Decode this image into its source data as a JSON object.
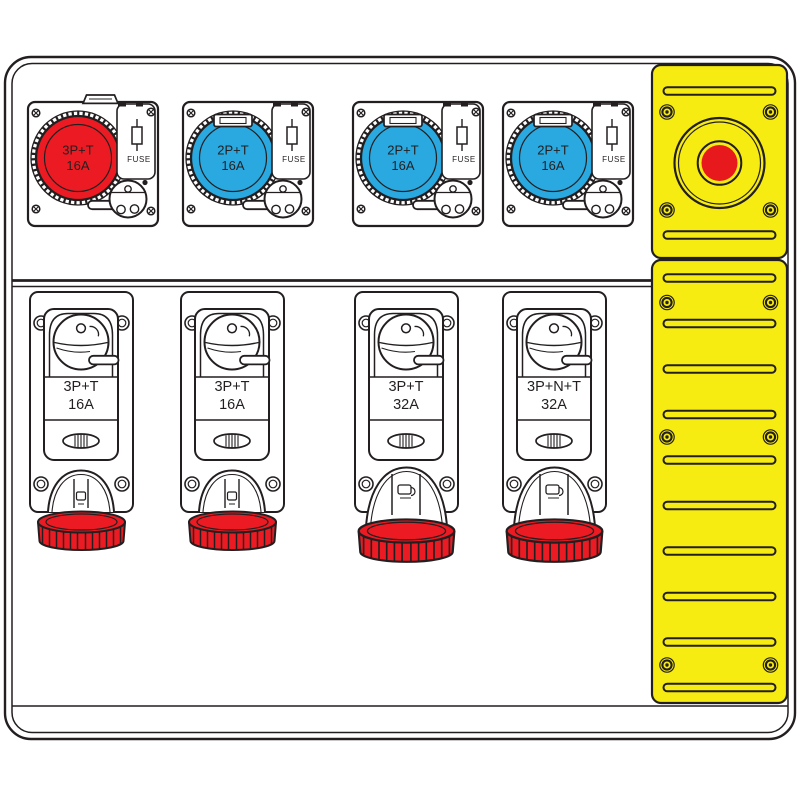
{
  "colors": {
    "line": "#231f20",
    "socket_red": "#ec1b23",
    "socket_blue": "#29a9e0",
    "panel_yellow": "#f7ec11",
    "button_red": "#e8191c",
    "cap_red": "#ec1b23"
  },
  "top_units": [
    {
      "type": "3P+T",
      "amp": "16A",
      "fuse_label": "FUSE",
      "socket_color": "#ec1b23"
    },
    {
      "type": "2P+T",
      "amp": "16A",
      "fuse_label": "FUSE",
      "socket_color": "#29a9e0"
    },
    {
      "type": "2P+T",
      "amp": "16A",
      "fuse_label": "FUSE",
      "socket_color": "#29a9e0"
    },
    {
      "type": "2P+T",
      "amp": "16A",
      "fuse_label": "FUSE",
      "socket_color": "#29a9e0"
    }
  ],
  "bottom_units": [
    {
      "type": "3P+T",
      "amp": "16A"
    },
    {
      "type": "3P+T",
      "amp": "16A"
    },
    {
      "type": "3P+T",
      "amp": "32A"
    },
    {
      "type": "3P+N+T",
      "amp": "32A"
    }
  ]
}
